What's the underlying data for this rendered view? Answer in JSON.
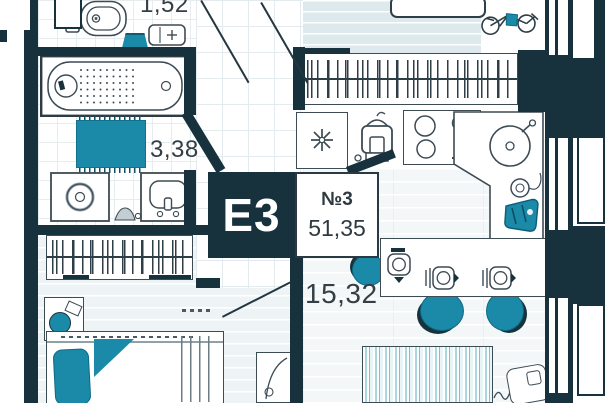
{
  "badge": {
    "type_label": "E3",
    "unit_label": "№3",
    "total_area": "51,35"
  },
  "areas": {
    "wc": "1,52",
    "bathroom": "3,38",
    "kitchen_living": "15,32"
  },
  "colors": {
    "wall": "#17323c",
    "accent_teal": "#1b89a8",
    "outline": "#3d4b54",
    "floor_tint": "#dde9ec",
    "label_text": "#333e45"
  },
  "icons": {
    "asterisk_glyph": "✳"
  }
}
